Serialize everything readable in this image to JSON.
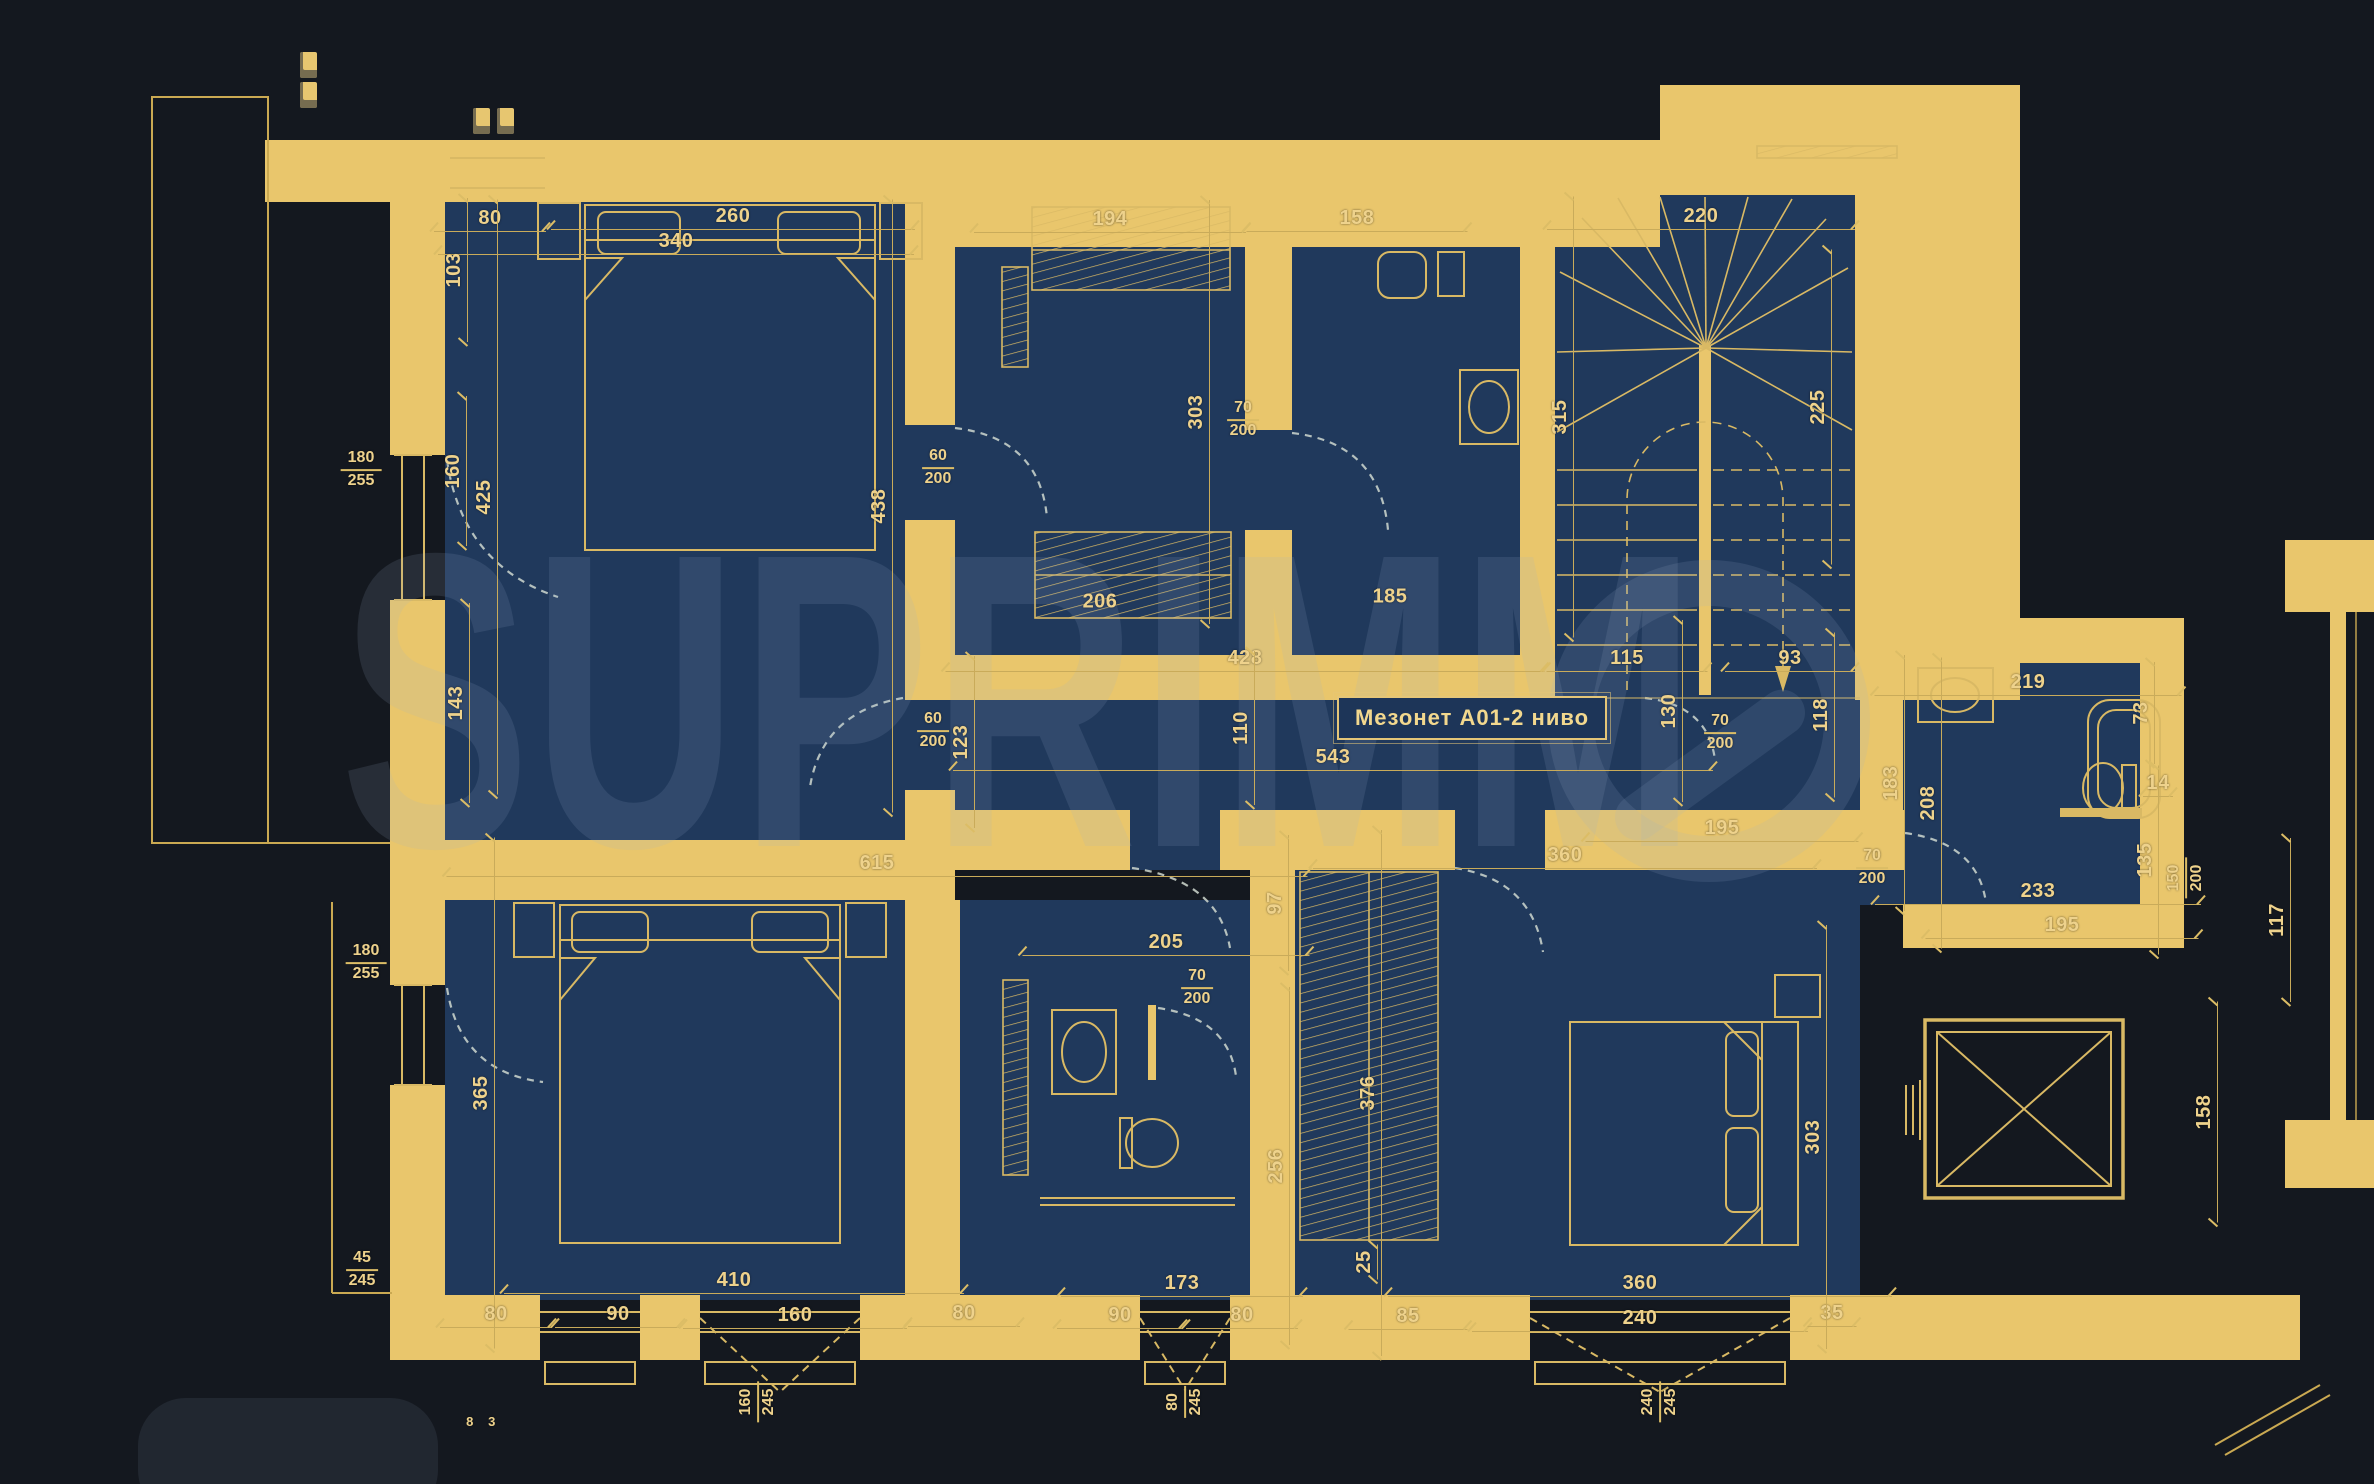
{
  "title": {
    "text": "Мезонет А01-2 ниво"
  },
  "watermark": {
    "brand": "SUPRIMMO",
    "text_display": "SUPRIMM"
  },
  "colors": {
    "background": "#14181f",
    "wall_fill": "#e9c66c",
    "room_fill": "#20395c",
    "line": "#d9b964",
    "dim_text": "#eed28c",
    "watermark": "rgba(158,176,205,0.14)"
  },
  "labels": [
    {
      "t": "260",
      "x": 733,
      "y": 218
    },
    {
      "t": "340",
      "x": 676,
      "y": 243
    },
    {
      "t": "80",
      "x": 490,
      "y": 220
    },
    {
      "t": "103",
      "x": 456,
      "y": 270,
      "r": -90
    },
    {
      "t": "160",
      "x": 455,
      "y": 471,
      "r": -90,
      "l": 150
    },
    {
      "t": "425",
      "x": 486,
      "y": 497,
      "r": -90
    },
    {
      "t": "143",
      "x": 458,
      "y": 703,
      "r": -90
    },
    {
      "t": "438",
      "x": 881,
      "y": 506,
      "r": -90
    },
    {
      "t": "194",
      "x": 1110,
      "y": 221
    },
    {
      "t": "206",
      "x": 1100,
      "y": 603,
      "l": 0
    },
    {
      "t": "303",
      "x": 1198,
      "y": 412,
      "r": -90
    },
    {
      "t": "158",
      "x": 1357,
      "y": 220
    },
    {
      "t": "185",
      "x": 1390,
      "y": 598,
      "l": 0
    },
    {
      "t": "220",
      "x": 1701,
      "y": 218
    },
    {
      "t": "315",
      "x": 1562,
      "y": 417,
      "r": -90
    },
    {
      "t": "225",
      "x": 1820,
      "y": 407,
      "r": -90
    },
    {
      "t": "428",
      "x": 1245,
      "y": 660
    },
    {
      "t": "110",
      "x": 1243,
      "y": 728,
      "r": -90
    },
    {
      "t": "543",
      "x": 1333,
      "y": 759
    },
    {
      "t": "123",
      "x": 963,
      "y": 742,
      "r": -90
    },
    {
      "t": "615",
      "x": 877,
      "y": 865
    },
    {
      "t": "115",
      "x": 1627,
      "y": 660
    },
    {
      "t": "93",
      "x": 1790,
      "y": 660
    },
    {
      "t": "130",
      "x": 1671,
      "y": 711,
      "r": -90
    },
    {
      "t": "118",
      "x": 1823,
      "y": 715,
      "r": -90
    },
    {
      "t": "195",
      "x": 1722,
      "y": 830
    },
    {
      "t": "360",
      "x": 1565,
      "y": 857
    },
    {
      "t": "183",
      "x": 1893,
      "y": 783,
      "r": -90
    },
    {
      "t": "208",
      "x": 1930,
      "y": 803,
      "r": -90
    },
    {
      "t": "219",
      "x": 2028,
      "y": 684
    },
    {
      "t": "73",
      "x": 2143,
      "y": 713,
      "r": -90
    },
    {
      "t": "14",
      "x": 2158,
      "y": 785,
      "l": 30
    },
    {
      "t": "135",
      "x": 2147,
      "y": 860,
      "r": -90
    },
    {
      "t": "233",
      "x": 2038,
      "y": 893
    },
    {
      "t": "195",
      "x": 2062,
      "y": 927
    },
    {
      "t": "117",
      "x": 2279,
      "y": 920,
      "r": -90
    },
    {
      "t": "158",
      "x": 2206,
      "y": 1112,
      "r": -90
    },
    {
      "t": "97",
      "x": 1277,
      "y": 903,
      "r": -90
    },
    {
      "t": "205",
      "x": 1166,
      "y": 944
    },
    {
      "t": "256",
      "x": 1278,
      "y": 1166,
      "r": -90
    },
    {
      "t": "376",
      "x": 1370,
      "y": 1093,
      "r": -90
    },
    {
      "t": "25",
      "x": 1366,
      "y": 1262,
      "r": -90
    },
    {
      "t": "173",
      "x": 1182,
      "y": 1285
    },
    {
      "t": "90",
      "x": 1120,
      "y": 1317
    },
    {
      "t": "80",
      "x": 1242,
      "y": 1317
    },
    {
      "t": "85",
      "x": 1408,
      "y": 1318
    },
    {
      "t": "360",
      "x": 1640,
      "y": 1285
    },
    {
      "t": "240",
      "x": 1640,
      "y": 1320
    },
    {
      "t": "35",
      "x": 1832,
      "y": 1315
    },
    {
      "t": "303",
      "x": 1815,
      "y": 1137,
      "r": -90
    },
    {
      "t": "365",
      "x": 483,
      "y": 1093,
      "r": -90
    },
    {
      "t": "410",
      "x": 734,
      "y": 1282,
      "l": 460
    },
    {
      "t": "80",
      "x": 496,
      "y": 1316
    },
    {
      "t": "90",
      "x": 618,
      "y": 1316
    },
    {
      "t": "160",
      "x": 795,
      "y": 1317
    },
    {
      "t": "80",
      "x": 964,
      "y": 1315
    },
    {
      "t": "8",
      "x": 470,
      "y": 1423,
      "l": 0,
      "s": 13
    },
    {
      "t": "3",
      "x": 492,
      "y": 1423,
      "l": 0,
      "s": 13
    }
  ],
  "fractions": [
    {
      "n": "180",
      "d": "255",
      "x": 361,
      "y": 470
    },
    {
      "n": "180",
      "d": "255",
      "x": 366,
      "y": 963
    },
    {
      "n": "60",
      "d": "200",
      "x": 938,
      "y": 468
    },
    {
      "n": "70",
      "d": "200",
      "x": 1243,
      "y": 420
    },
    {
      "n": "60",
      "d": "200",
      "x": 933,
      "y": 731
    },
    {
      "n": "70",
      "d": "200",
      "x": 1720,
      "y": 733
    },
    {
      "n": "70",
      "d": "200",
      "x": 1872,
      "y": 868
    },
    {
      "n": "70",
      "d": "200",
      "x": 1197,
      "y": 988
    },
    {
      "n": "150",
      "d": "200",
      "x": 2186,
      "y": 878,
      "r": -90
    },
    {
      "n": "45",
      "d": "245",
      "x": 362,
      "y": 1270
    },
    {
      "n": "160",
      "d": "245",
      "x": 758,
      "y": 1402,
      "r": -90
    },
    {
      "n": "80",
      "d": "245",
      "x": 1185,
      "y": 1402,
      "r": -90
    },
    {
      "n": "240",
      "d": "245",
      "x": 1660,
      "y": 1402,
      "r": -90
    }
  ]
}
